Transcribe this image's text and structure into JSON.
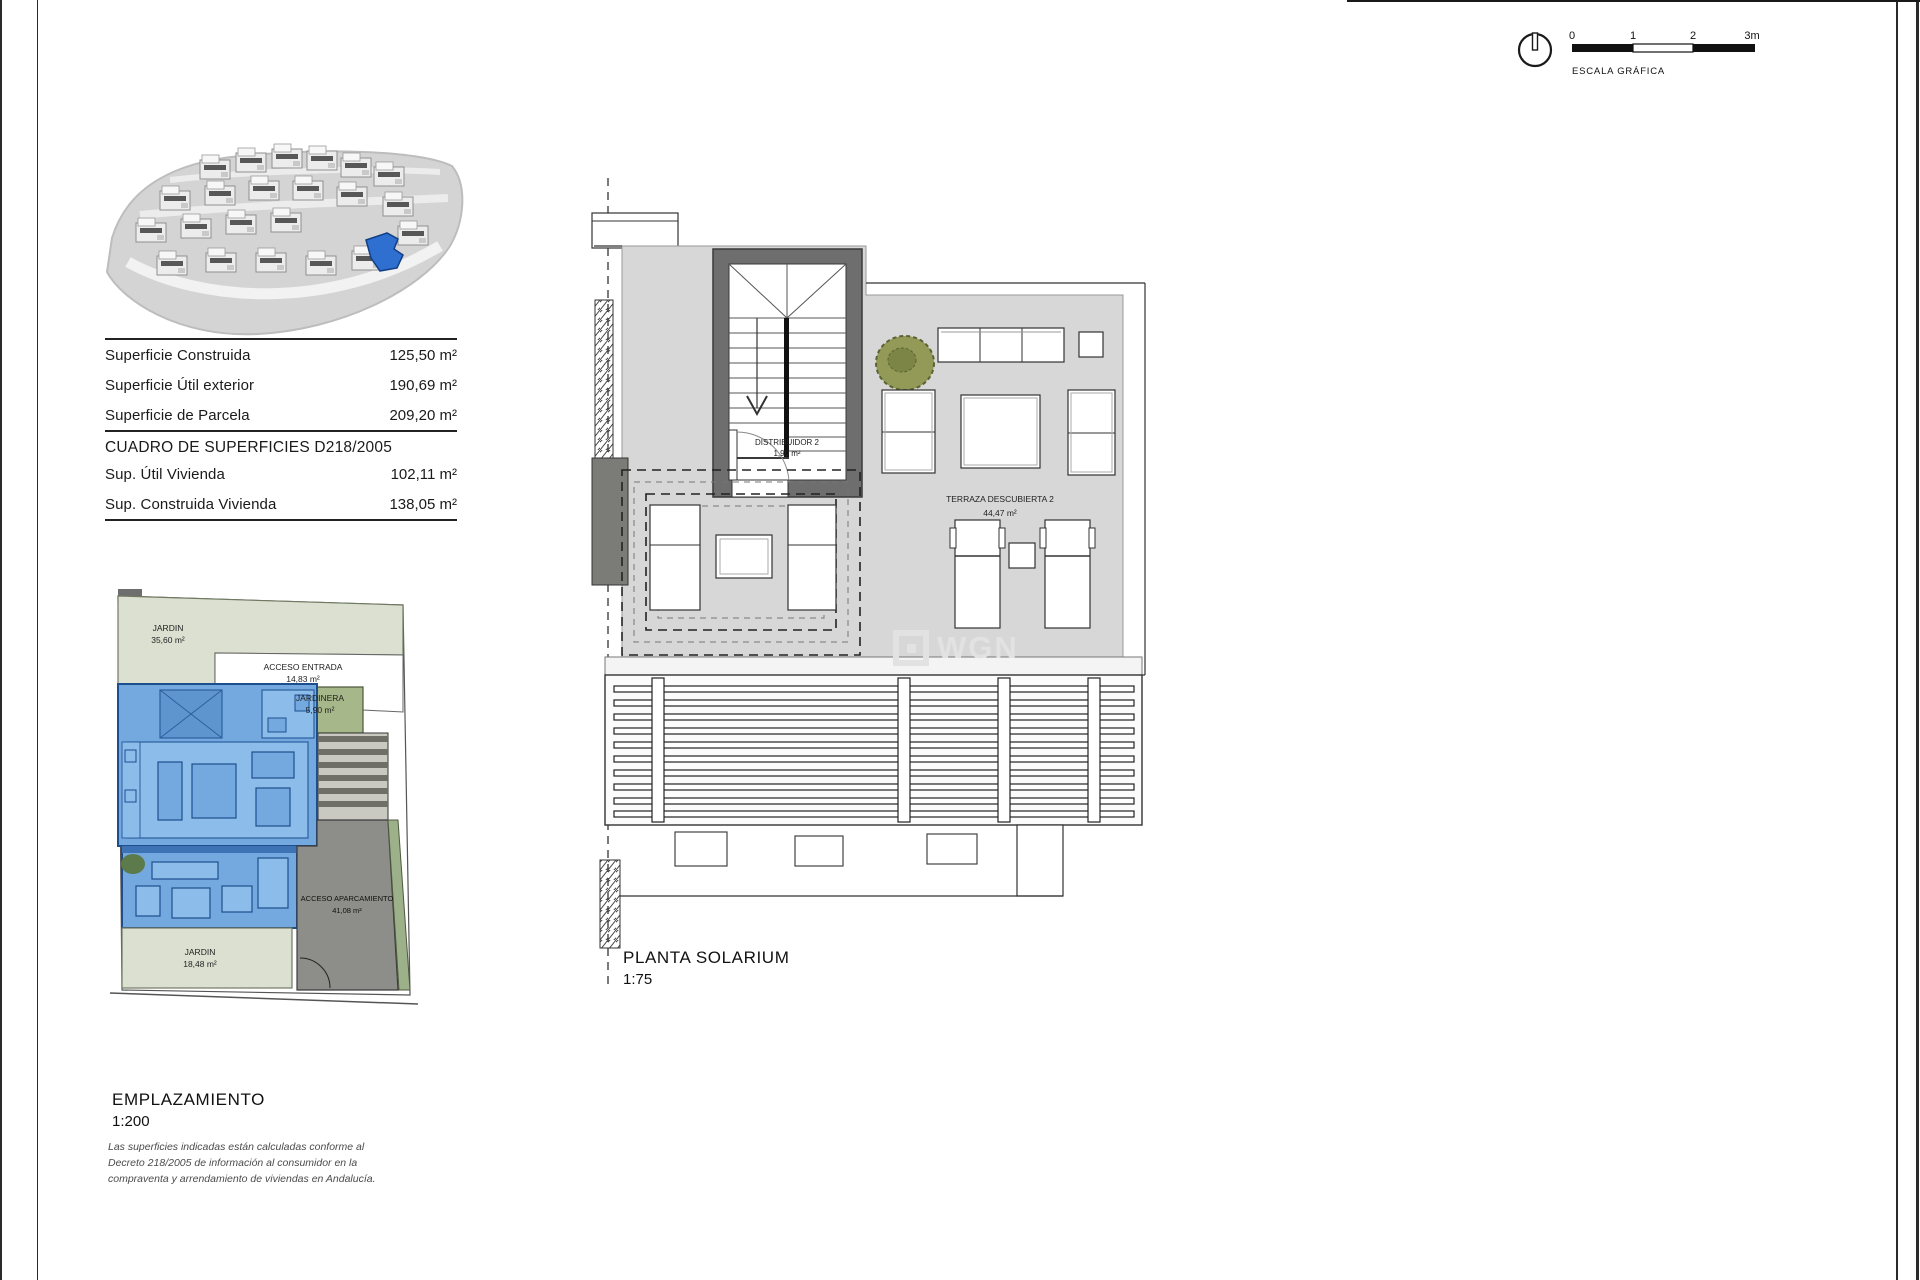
{
  "watermark": "WGN",
  "scale_bar": {
    "title": "ESCALA GRÁFICA",
    "ticks": [
      "0",
      "1",
      "2",
      "3m"
    ]
  },
  "surfaces_table": {
    "rows_top": [
      {
        "label": "Superficie Construida",
        "value": "125,50 m²"
      },
      {
        "label": "Superficie Útil exterior",
        "value": "190,69 m²"
      },
      {
        "label": "Superficie de Parcela",
        "value": "209,20 m²"
      }
    ],
    "section_title": "CUADRO DE SUPERFICIES D218/2005",
    "rows_bottom": [
      {
        "label": "Sup. Útil Vivienda",
        "value": "102,11 m²"
      },
      {
        "label": "Sup. Construida Vivienda",
        "value": "138,05 m²"
      }
    ]
  },
  "solarium_plan": {
    "title": "PLANTA SOLARIUM",
    "scale": "1:75",
    "rooms": [
      {
        "name": "DISTRIBUIDOR 2",
        "area": "1,90 m²"
      },
      {
        "name": "TERRAZA DESCUBIERTA 2",
        "area": "44,47 m²"
      }
    ]
  },
  "site_plan": {
    "title": "EMPLAZAMIENTO",
    "scale": "1:200",
    "areas": [
      {
        "name": "JARDIN",
        "area": "35,60 m²"
      },
      {
        "name": "ACCESO ENTRADA",
        "area": "14,83 m²"
      },
      {
        "name": "JARDINERA",
        "area": "5,90 m²"
      },
      {
        "name": "ACCESO APARCAMIENTO",
        "area": "41,08 m²"
      },
      {
        "name": "JARDIN",
        "area": "18,48 m²"
      }
    ]
  },
  "disclaimer": "Las superficies indicadas están calculadas conforme al Decreto 218/2005 de información al consumidor en la compraventa y arrendamiento de viviendas en Andalucía.",
  "colors": {
    "terrace_gray": "#d7d7d7",
    "core_wall": "#6e6e6e",
    "garden_sage": "#dce0d0",
    "planter_green": "#a6b789",
    "unit_blue": "#74a9df",
    "unit_blue_dark": "#1d4e8d",
    "parking_gray": "#8d8d89",
    "highlight_blue": "#2e6fd0"
  }
}
